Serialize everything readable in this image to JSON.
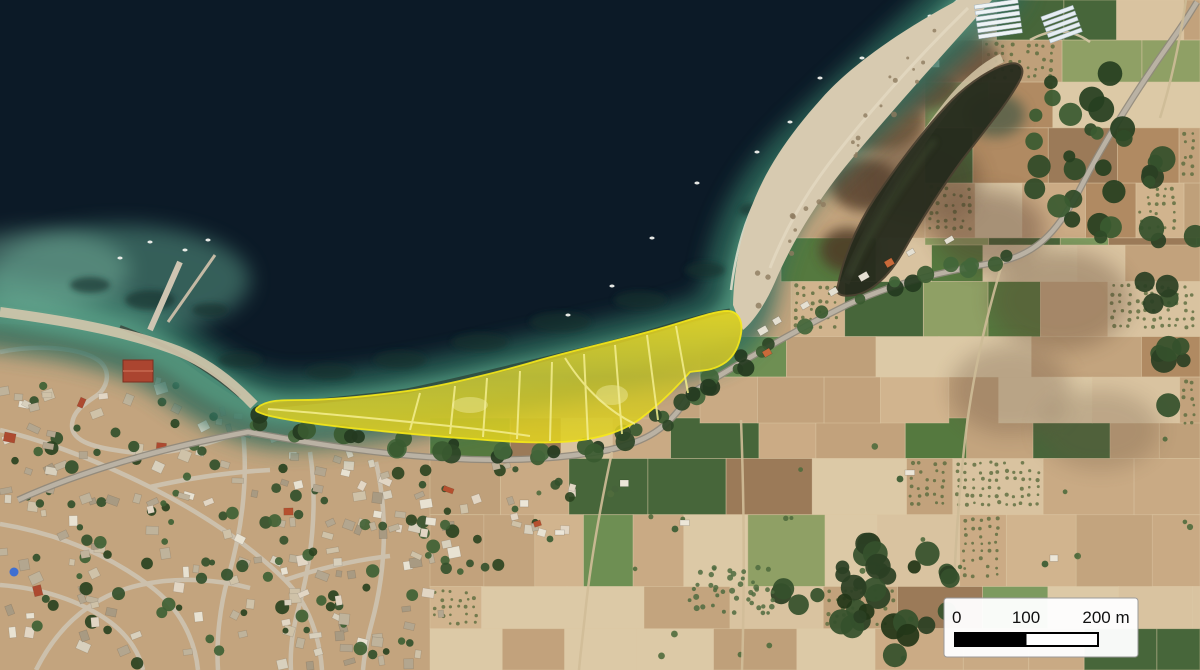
{
  "meta": {
    "title": "Coastal satellite map with highlighted shoreline study area",
    "type": "satellite-aerial-imagery",
    "overlay_note": "Semi-transparent yellow polygon highlighting a crescent-shaped coastal strip between the beach and the coastal road"
  },
  "scale_bar": {
    "labels": {
      "start": "0",
      "middle": "100",
      "end": "200 m"
    },
    "tick_values_m": [
      0,
      100,
      200
    ]
  },
  "colors": {
    "highlight_yellow": "#eed91e",
    "highlight_yellow_olive": "#c9bf2b",
    "sea_deep": "#0c1a27",
    "sea_shallow": "#2f6b5c",
    "sea_nearshore": "#52987f",
    "beach_sand": "#d7cab0",
    "land_tan": "#c3a47e",
    "forest_green": "#2f4a28",
    "road_gray": "#bab2a4",
    "lagoon_dark": "#262b1d",
    "scale_bar_bg": "#ffffff",
    "scale_bar_text": "#111111"
  }
}
